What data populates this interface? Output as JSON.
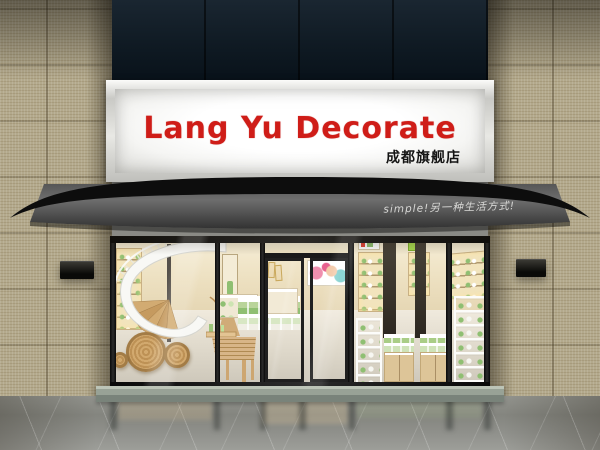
{
  "signboard": {
    "title": "Lang Yu Decorate",
    "subtitle": "成都旗舰店"
  },
  "awning": {
    "slogan": "simple!另一种生活方式!"
  },
  "theme": {
    "title-red": "#cf1d18",
    "subtitle-ink": "#141414",
    "sign-face": "#f5f5f3",
    "facade-navy": "#101b24",
    "wall-tile": "#b3a98c",
    "awning-dark": "#0d0d0d",
    "awning-fascia-light": "#6e6e6e",
    "awning-fascia-dark": "#323232",
    "slogan-ink": "#d8d8d6",
    "interior-cream": "#ecdfbf",
    "product-green": "#8fbf72",
    "wood-tan": "#d2a96e",
    "floor-gray": "#84857f",
    "step-gray": "#98a296"
  }
}
